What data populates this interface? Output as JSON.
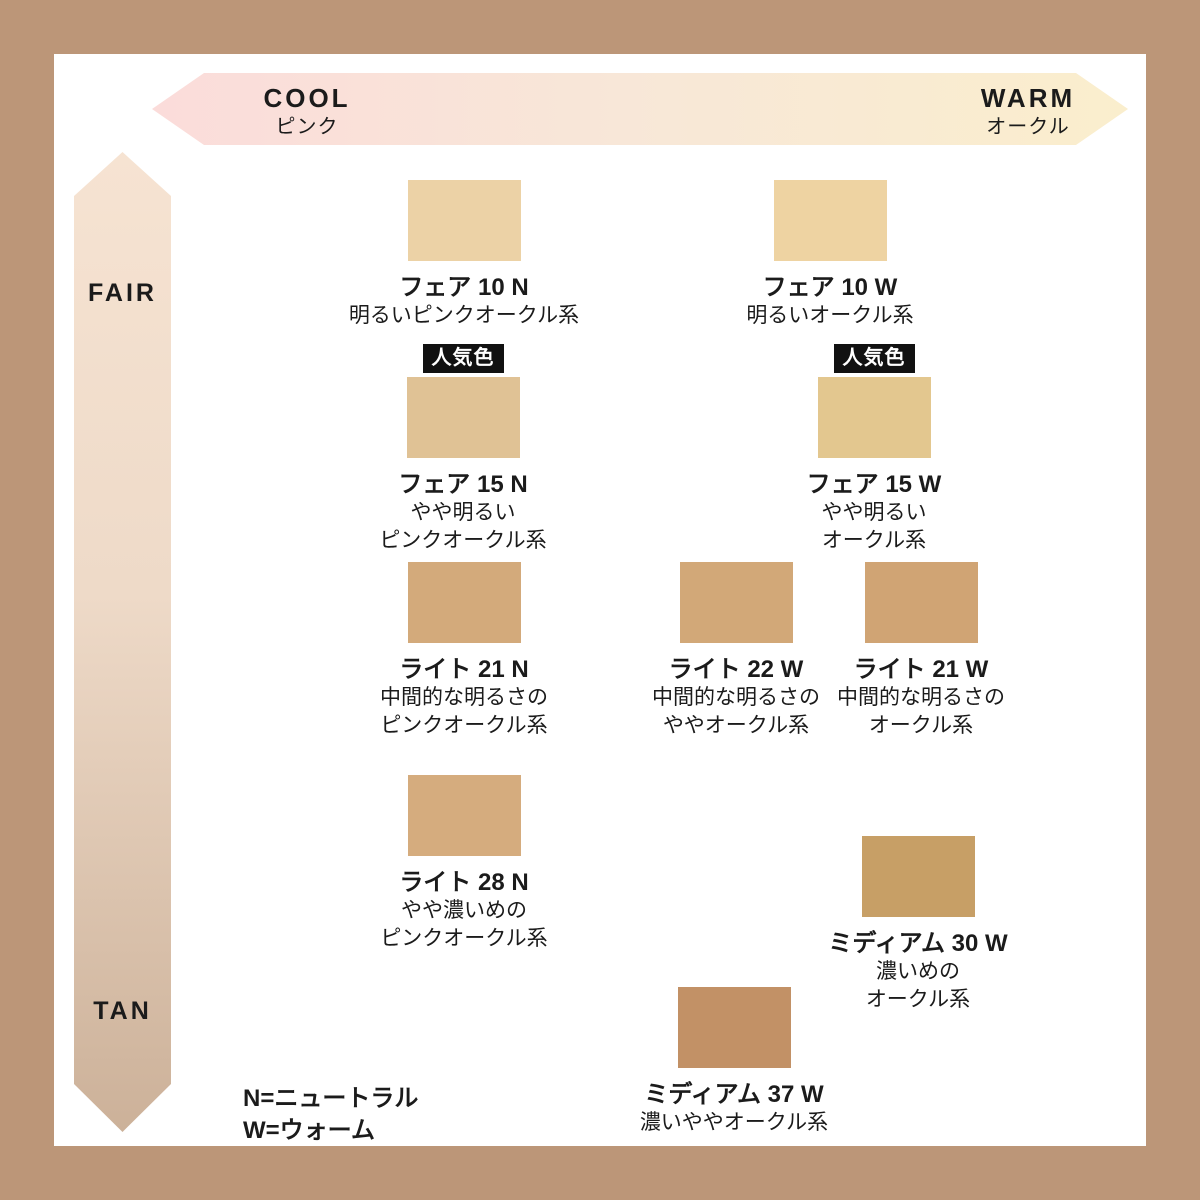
{
  "colors": {
    "frame": "#bc9678",
    "ink": "#1b1b1b",
    "badge-bg": "#111111",
    "badge-fg": "#ffffff",
    "arrow-pink": "#fbdcda",
    "arrow-peach": "#f8e7d8",
    "arrow-cream": "#faeecd",
    "fair-top": "#f6e3d2",
    "fair-mid": "#eedac8",
    "tan-bottom": "#ccb199"
  },
  "axes": {
    "horizontal": {
      "left_label": "COOL",
      "left_sub": "ピンク",
      "right_label": "WARM",
      "right_sub": "オークル"
    },
    "vertical": {
      "top_label": "FAIR",
      "bottom_label": "TAN"
    }
  },
  "badge_label": "人気色",
  "shades": [
    {
      "name": "フェア 10 N",
      "desc": [
        "明るいピンクオークル系"
      ],
      "color": "#ecd2a6",
      "popular": false
    },
    {
      "name": "フェア 10 W",
      "desc": [
        "明るいオークル系"
      ],
      "color": "#eed3a2",
      "popular": false
    },
    {
      "name": "フェア 15 N",
      "desc": [
        "やや明るい",
        "ピンクオークル系"
      ],
      "color": "#e0c295",
      "popular": true
    },
    {
      "name": "フェア 15 W",
      "desc": [
        "やや明るい",
        "オークル系"
      ],
      "color": "#e3c78f",
      "popular": true
    },
    {
      "name": "ライト 21 N",
      "desc": [
        "中間的な明るさの",
        "ピンクオークル系"
      ],
      "color": "#d3aa7b",
      "popular": false
    },
    {
      "name": "ライト 22 W",
      "desc": [
        "中間的な明るさの",
        "ややオークル系"
      ],
      "color": "#d2a878",
      "popular": false
    },
    {
      "name": "ライト 21 W",
      "desc": [
        "中間的な明るさの",
        "オークル系"
      ],
      "color": "#d0a474",
      "popular": false
    },
    {
      "name": "ライト 28 N",
      "desc": [
        "やや濃いめの",
        "ピンクオークル系"
      ],
      "color": "#d5ac7e",
      "popular": false
    },
    {
      "name": "ミディアム 30 W",
      "desc": [
        "濃いめの",
        "オークル系"
      ],
      "color": "#c79f66",
      "popular": false
    },
    {
      "name": "ミディアム 37 W",
      "desc": [
        "濃いややオークル系"
      ],
      "color": "#c29166",
      "popular": false
    }
  ],
  "legend": {
    "line1": "N=ニュートラル",
    "line2": "W=ウォーム"
  },
  "chart_data": {
    "type": "scatter",
    "title": "",
    "xlabel": "COOL (ピンク) → WARM (オークル)",
    "ylabel": "FAIR → TAN",
    "legend_position": "bottom-left",
    "annotations": [
      "人気色: フェア 15 N",
      "人気色: フェア 15 W",
      "N=ニュートラル",
      "W=ウォーム"
    ],
    "series": [
      {
        "name": "フェア 10 N",
        "undertone": "N",
        "tone_description": "明るいピンクオークル系",
        "swatch_hex": "#ecd2a6",
        "cool_warm_x": 0.32,
        "fair_tan_y": 0.05,
        "popular": false
      },
      {
        "name": "フェア 10 W",
        "undertone": "W",
        "tone_description": "明るいオークル系",
        "swatch_hex": "#eed3a2",
        "cool_warm_x": 0.7,
        "fair_tan_y": 0.05,
        "popular": false
      },
      {
        "name": "フェア 15 N",
        "undertone": "N",
        "tone_description": "やや明るいピンクオークル系",
        "swatch_hex": "#e0c295",
        "cool_warm_x": 0.32,
        "fair_tan_y": 0.25,
        "popular": true
      },
      {
        "name": "フェア 15 W",
        "undertone": "W",
        "tone_description": "やや明るいオークル系",
        "swatch_hex": "#e3c78f",
        "cool_warm_x": 0.74,
        "fair_tan_y": 0.25,
        "popular": true
      },
      {
        "name": "ライト 21 N",
        "undertone": "N",
        "tone_description": "中間的な明るさのピンクオークル系",
        "swatch_hex": "#d3aa7b",
        "cool_warm_x": 0.32,
        "fair_tan_y": 0.45,
        "popular": false
      },
      {
        "name": "ライト 22 W",
        "undertone": "W",
        "tone_description": "中間的な明るさのややオークル系",
        "swatch_hex": "#d2a878",
        "cool_warm_x": 0.6,
        "fair_tan_y": 0.45,
        "popular": false
      },
      {
        "name": "ライト 21 W",
        "undertone": "W",
        "tone_description": "中間的な明るさのオークル系",
        "swatch_hex": "#d0a474",
        "cool_warm_x": 0.79,
        "fair_tan_y": 0.45,
        "popular": false
      },
      {
        "name": "ライト 28 N",
        "undertone": "N",
        "tone_description": "やや濃いめのピンクオークル系",
        "swatch_hex": "#d5ac7e",
        "cool_warm_x": 0.32,
        "fair_tan_y": 0.66,
        "popular": false
      },
      {
        "name": "ミディアム 30 W",
        "undertone": "W",
        "tone_description": "濃いめのオークル系",
        "swatch_hex": "#c79f66",
        "cool_warm_x": 0.79,
        "fair_tan_y": 0.72,
        "popular": false
      },
      {
        "name": "ミディアム 37 W",
        "undertone": "W",
        "tone_description": "濃いややオークル系",
        "swatch_hex": "#c29166",
        "cool_warm_x": 0.6,
        "fair_tan_y": 0.87,
        "popular": false
      }
    ]
  }
}
